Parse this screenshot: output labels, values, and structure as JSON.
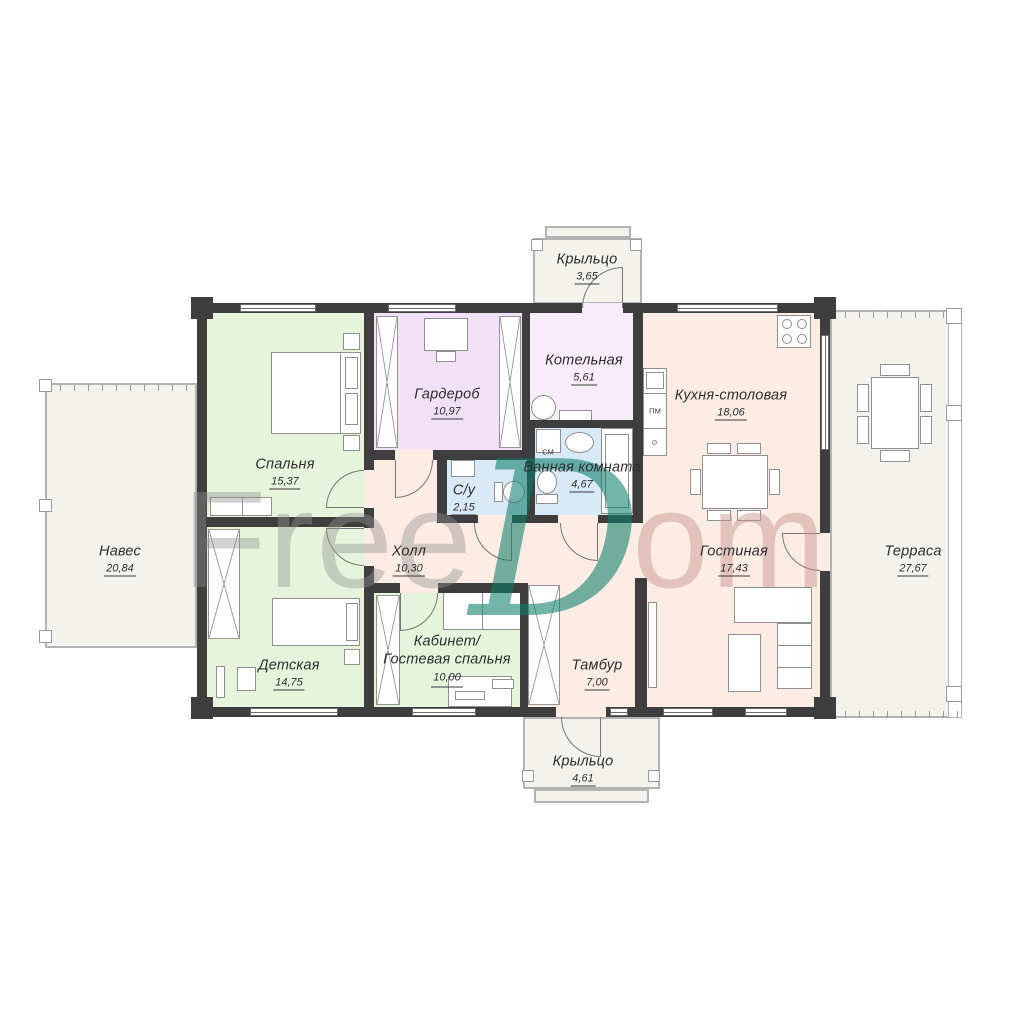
{
  "watermark": {
    "free": "Free",
    "d": "D",
    "om": "om"
  },
  "rooms": {
    "porch_top": {
      "name": "Крыльцо",
      "area": "3,65"
    },
    "bedroom": {
      "name": "Спальня",
      "area": "15,37"
    },
    "wardrobe": {
      "name": "Гардероб",
      "area": "10,97"
    },
    "boiler": {
      "name": "Котельная",
      "area": "5,61"
    },
    "kitchen": {
      "name": "Кухня-столовая",
      "area": "18,06"
    },
    "canopy": {
      "name": "Навес",
      "area": "20,84"
    },
    "wc": {
      "name": "С/у",
      "area": "2,15"
    },
    "bathroom": {
      "name": "Ванная комната",
      "area": "4,67"
    },
    "hall": {
      "name": "Холл",
      "area": "10,30"
    },
    "living": {
      "name": "Гостиная",
      "area": "17,43"
    },
    "terrace": {
      "name": "Терраса",
      "area": "27,67"
    },
    "children": {
      "name": "Детская",
      "area": "14,75"
    },
    "office": {
      "name": "Кабинет/Гостевая спальня",
      "area": "10,00"
    },
    "vestibule": {
      "name": "Тамбур",
      "area": "7,00"
    },
    "porch_bottom": {
      "name": "Крыльцо",
      "area": "4,61"
    }
  },
  "appliance_labels": {
    "washing_machine": "СМ",
    "dishwasher": "ПМ"
  },
  "colors": {
    "wall": "#3e3e3e",
    "floor_pink": "#fdece4",
    "floor_green": "#e6f4db",
    "floor_purple": "#f2e0f6",
    "floor_purple_light": "#f8ecfa",
    "floor_blue": "#d8e9f7",
    "outdoor": "#f3f2ed",
    "watermark_teal": "#0c7d69"
  }
}
